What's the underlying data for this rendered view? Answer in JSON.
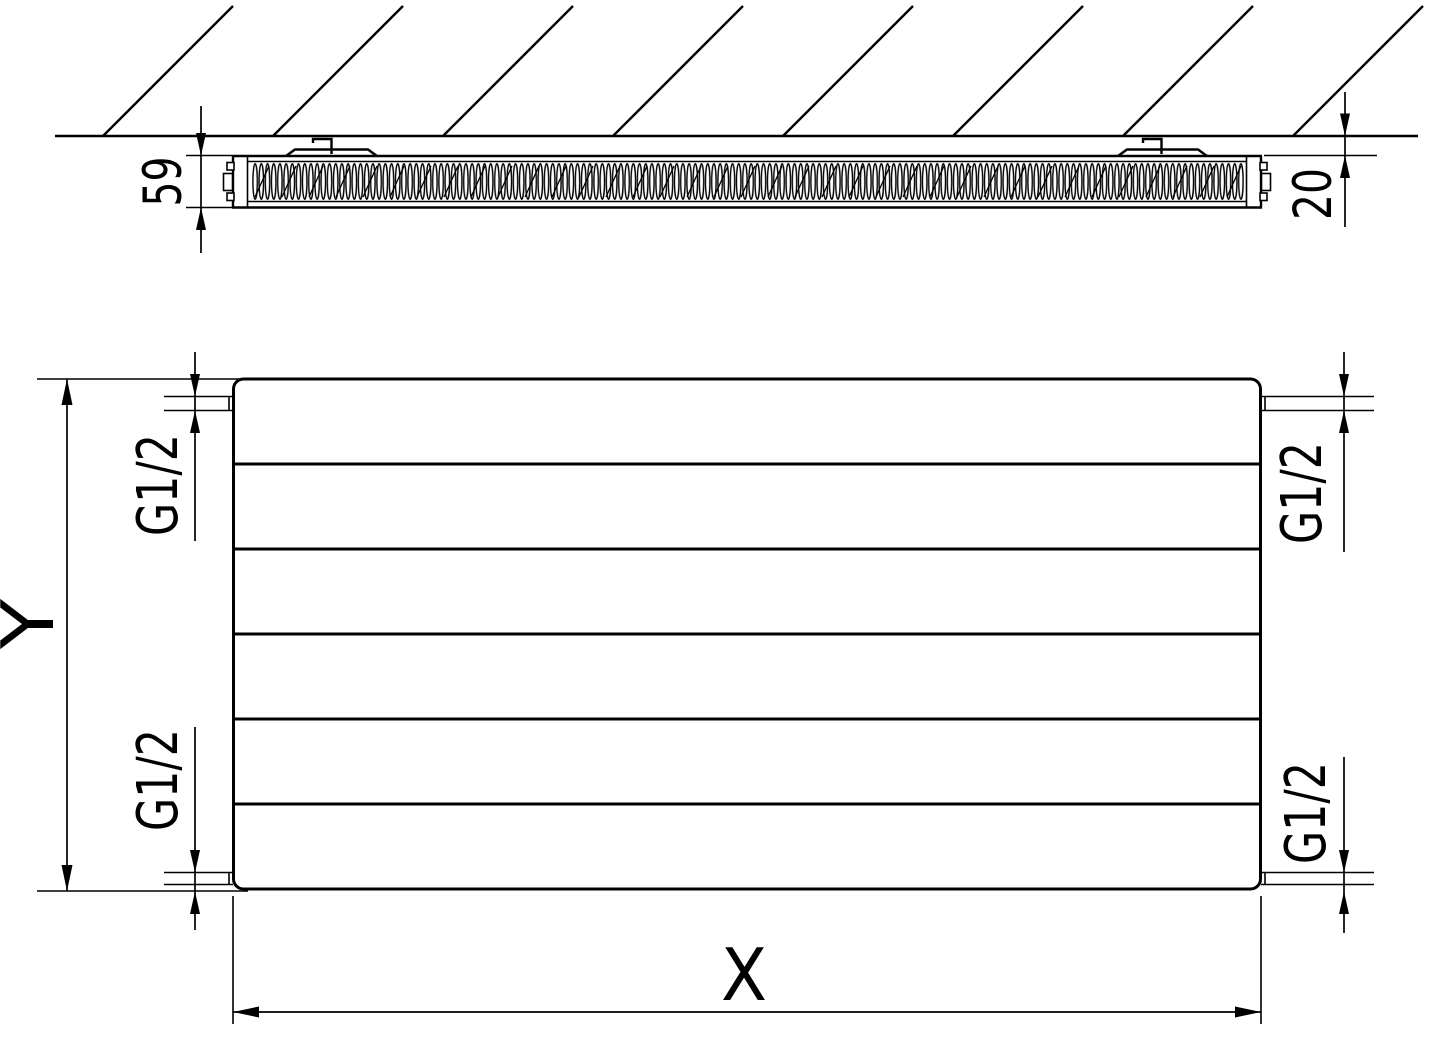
{
  "drawing": {
    "type": "radiator-technical-drawing",
    "line_color": "#000000",
    "background_color": "#ffffff"
  },
  "side_view": {
    "depth_label": "59",
    "wall_gap_label": "20"
  },
  "front_view": {
    "width_label": "X",
    "height_label": "Y",
    "connection_top_left": "G1/2",
    "connection_top_right": "G1/2",
    "connection_bottom_left": "G1/2",
    "connection_bottom_right": "G1/2"
  }
}
